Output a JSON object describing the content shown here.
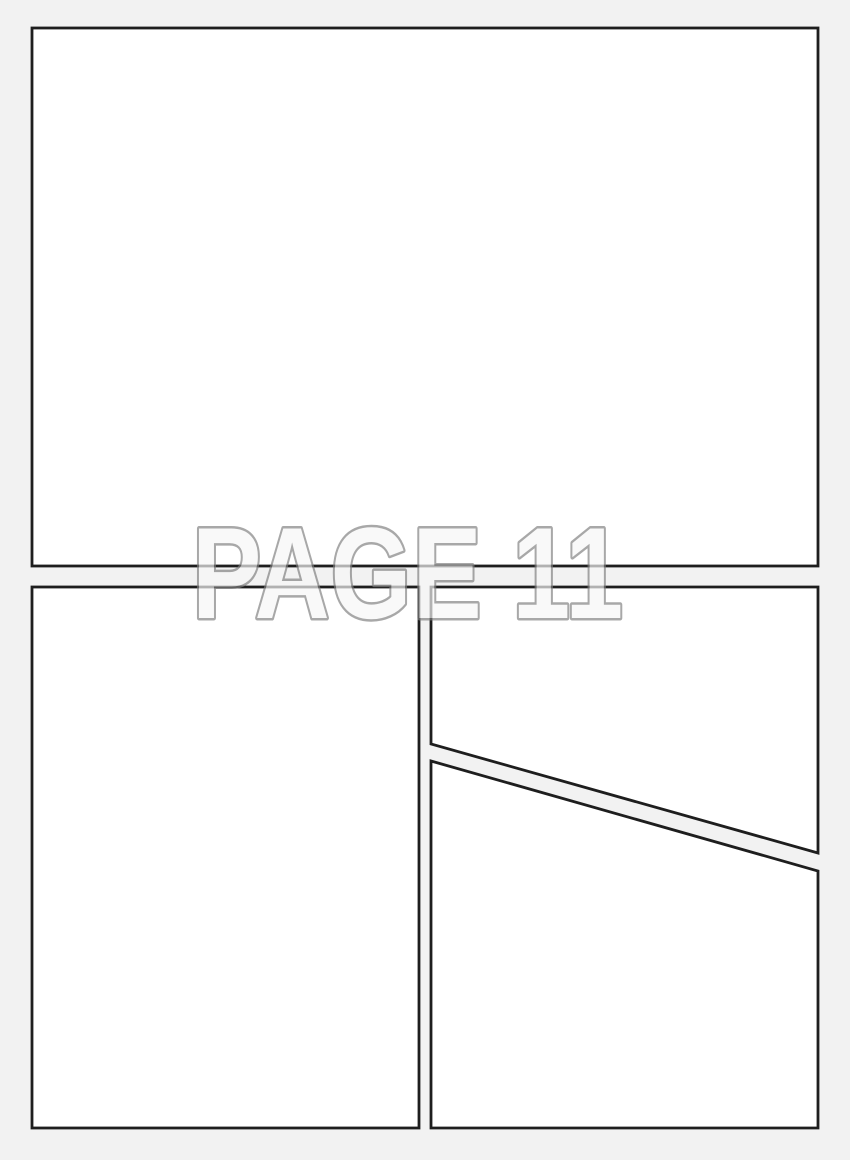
{
  "page": {
    "watermark": "PAGE 11",
    "colors": {
      "background": "#f2f2f2",
      "panel_fill": "#ffffff",
      "panel_border": "#1e1e1e",
      "watermark_fill": "#f7f7f7",
      "watermark_stroke": "#7f7f7f"
    }
  }
}
